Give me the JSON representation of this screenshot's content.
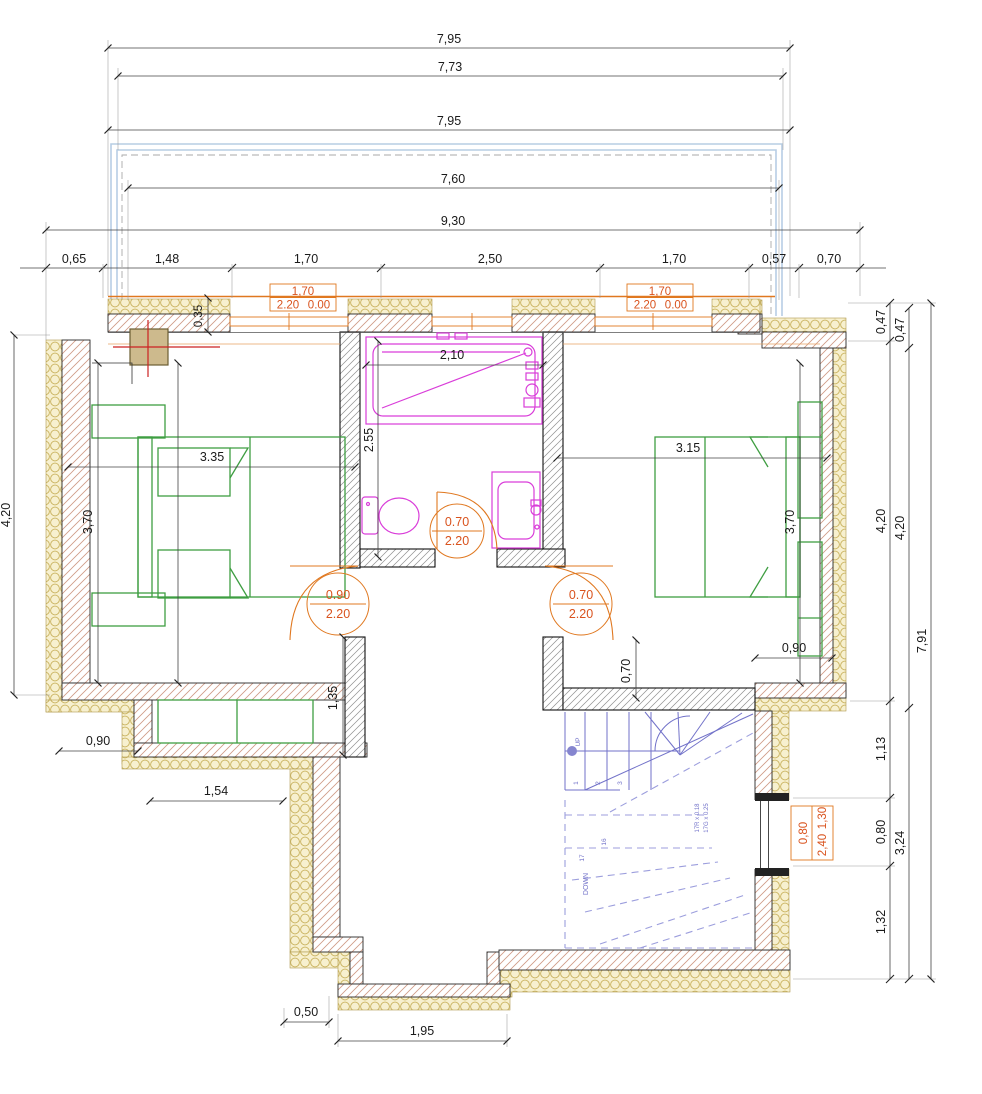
{
  "palette": {
    "dimension_lines": "#444444",
    "annotation_orange": "#e07820",
    "label_orange_red": "#d9531e",
    "furniture_green": "#3f9e42",
    "fixture_magenta": "#d93dd9",
    "stair_blue": "#7272c9",
    "roof_overhang_blue": "#b7cde4",
    "insulation_cream": "#f7f0cf",
    "chimney_tan": "#cdba8d",
    "axis_red": "#cc2222"
  },
  "dimensions": {
    "top": [
      "7,95",
      "7,73",
      "7,95",
      "7,60",
      "9,30"
    ],
    "top_row": [
      "0,65",
      "1,48",
      "1,70",
      "2,50",
      "1,70",
      "0,57",
      "0,70"
    ],
    "right_col1": [
      "0,47",
      "4,20",
      "1,13",
      "0,80",
      "1,32"
    ],
    "right_col2": [
      "0,47",
      "4,20",
      "3,24"
    ],
    "right_total": "7,91",
    "left_height": "4,20",
    "wall_thickness": "0,35",
    "bedroom_left": {
      "width": "3.35",
      "depth": "3,70"
    },
    "bedroom_right": {
      "width": "3.15",
      "depth": "3,70",
      "nook": "0,90",
      "stub": "0,70"
    },
    "bathroom": {
      "tub": "2,10",
      "depth": "2.55"
    },
    "hall": {
      "stub": "1,35"
    },
    "steps": {
      "offset": "0,90",
      "ledge": "1,54"
    },
    "bay": {
      "offset": "0,50",
      "width": "1,95"
    }
  },
  "doors": {
    "bedroom_left": {
      "width": "0.90",
      "height": "2.20"
    },
    "bedroom_right": {
      "width": "0.70",
      "height": "2.20"
    },
    "bathroom": {
      "width": "0.70",
      "height": "2.20"
    }
  },
  "windows": {
    "top_left": {
      "width": "1,70",
      "height": "2.20",
      "sill": "0.00"
    },
    "top_right": {
      "width": "1,70",
      "height": "2.20",
      "sill": "0.00"
    },
    "stair": {
      "width": "0,80",
      "height": "2,40",
      "sill": "1,30"
    }
  },
  "stairs": {
    "up": "UP",
    "down": "DOWN",
    "riser_spec": "17R x 0.18",
    "going_spec": "17G x 0.25",
    "step_numbers": [
      "1",
      "2",
      "3"
    ],
    "upper_step_numbers": [
      "16",
      "17"
    ]
  }
}
